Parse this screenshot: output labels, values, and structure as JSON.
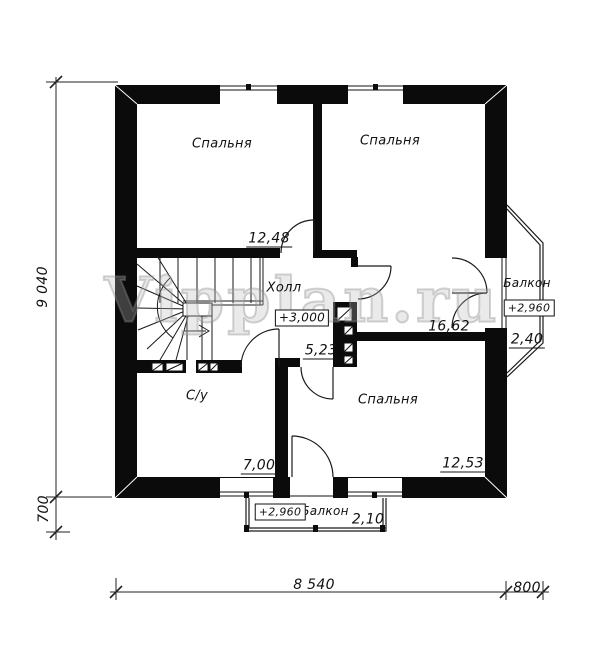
{
  "watermark": "Vipplan.ru",
  "rooms": {
    "bedroom_top_left": {
      "label": "Спальня",
      "area": "12,48"
    },
    "bedroom_top_right": {
      "label": "Спальня",
      "area": "16,62"
    },
    "bedroom_bottom": {
      "label": "Спальня",
      "area": "12,53"
    },
    "hall": {
      "label": "Холл",
      "area": "5,23",
      "elevation": "+3,000"
    },
    "bathroom": {
      "label": "С/у",
      "area": "7,00"
    },
    "balcony_right": {
      "label": "Балкон",
      "area": "2,40",
      "elevation": "+2,960"
    },
    "balcony_bottom": {
      "label": "Балкон",
      "area": "2,10",
      "elevation": "+2,960"
    }
  },
  "dimensions": {
    "height_total": "9 040",
    "balcony_depth": "700",
    "width_main": "8 540",
    "balcony_width": "800"
  }
}
